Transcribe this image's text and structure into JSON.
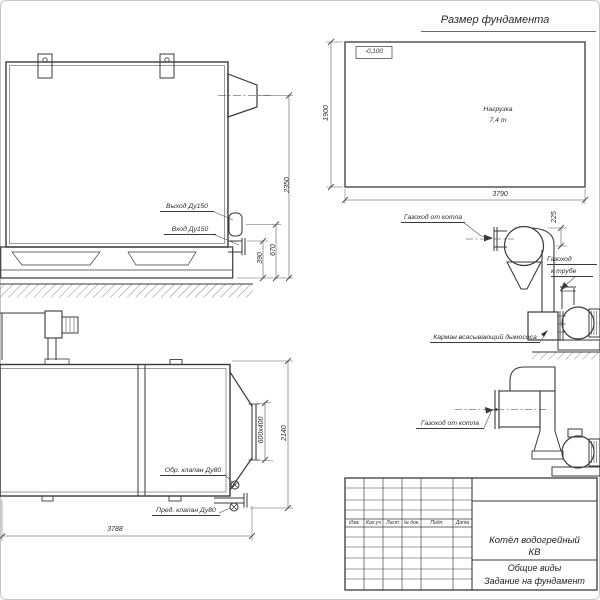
{
  "drawing": {
    "side_view": {
      "outlet_label": "Выход Ду150",
      "inlet_label": "Вход Ду150",
      "dim_total_height": "2350",
      "dim_outlet_height": "670",
      "dim_inlet_height": "390"
    },
    "foundation_plan": {
      "title": "Размер фундамента",
      "elevation_mark": "-0,100",
      "load_label_line1": "Нагрузка",
      "load_label_line2": "7,4 т",
      "dim_length": "3790",
      "dim_width": "1900"
    },
    "flue_with_cyclone": {
      "from_boiler_label": "Газоход от котла",
      "to_stack_label_line1": "Газоход",
      "to_stack_label_line2": "к трубе",
      "pocket_label": "Карман всасывающий дымососа",
      "dim_offset": "225"
    },
    "plan_view": {
      "check_valve_label": "Обр. клапан Ду80",
      "safety_valve_label": "Пред. клапан Ду80",
      "dim_length": "3788",
      "dim_width": "2140",
      "dim_outlet": "600x400"
    },
    "flue_direct": {
      "from_boiler_label": "Газоход от котла"
    },
    "title_block": {
      "columns": [
        "Изм.",
        "Кол.уч",
        "Лист",
        "№ док.",
        "Подп.",
        "Дата"
      ],
      "product_line1": "Котёл водогрейный",
      "product_line2": "КВ",
      "doc_line1": "Общие виды",
      "doc_line2": "Задание на фундамент"
    }
  }
}
